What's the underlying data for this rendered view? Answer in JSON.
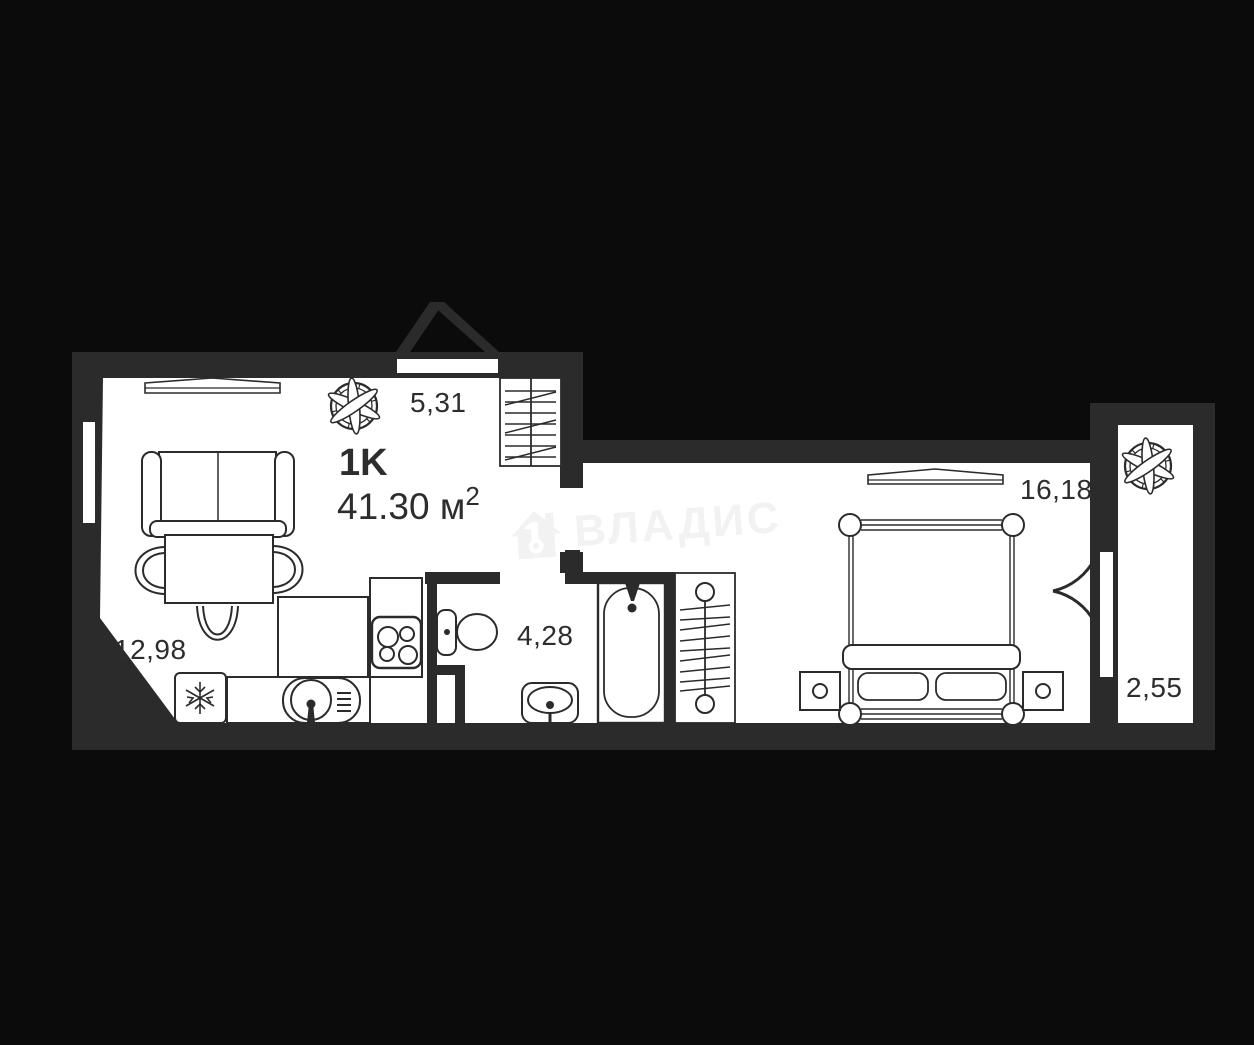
{
  "plan": {
    "title": {
      "type_label": "1K",
      "area_value": "41.30",
      "area_unit": " м",
      "area_sup": "2"
    },
    "rooms": {
      "living_kitchen": "12,98",
      "hallway": "5,31",
      "bathroom": "4,28",
      "bedroom": "16,18",
      "balcony": "2,55"
    },
    "watermark": {
      "brand": "ВЛАДИС"
    },
    "colors": {
      "background": "#0b0b0b",
      "walls": "#2b2b2b",
      "floor": "#ffffff",
      "ink": "#2d2d2d",
      "watermark": "#f2f2f2"
    },
    "icons": {
      "living_vent": "fan-rose-icon",
      "balcony_vent": "fan-rose-icon",
      "fridge": "snowflake-icon",
      "entrance": "entrance-arrow-icon"
    }
  }
}
